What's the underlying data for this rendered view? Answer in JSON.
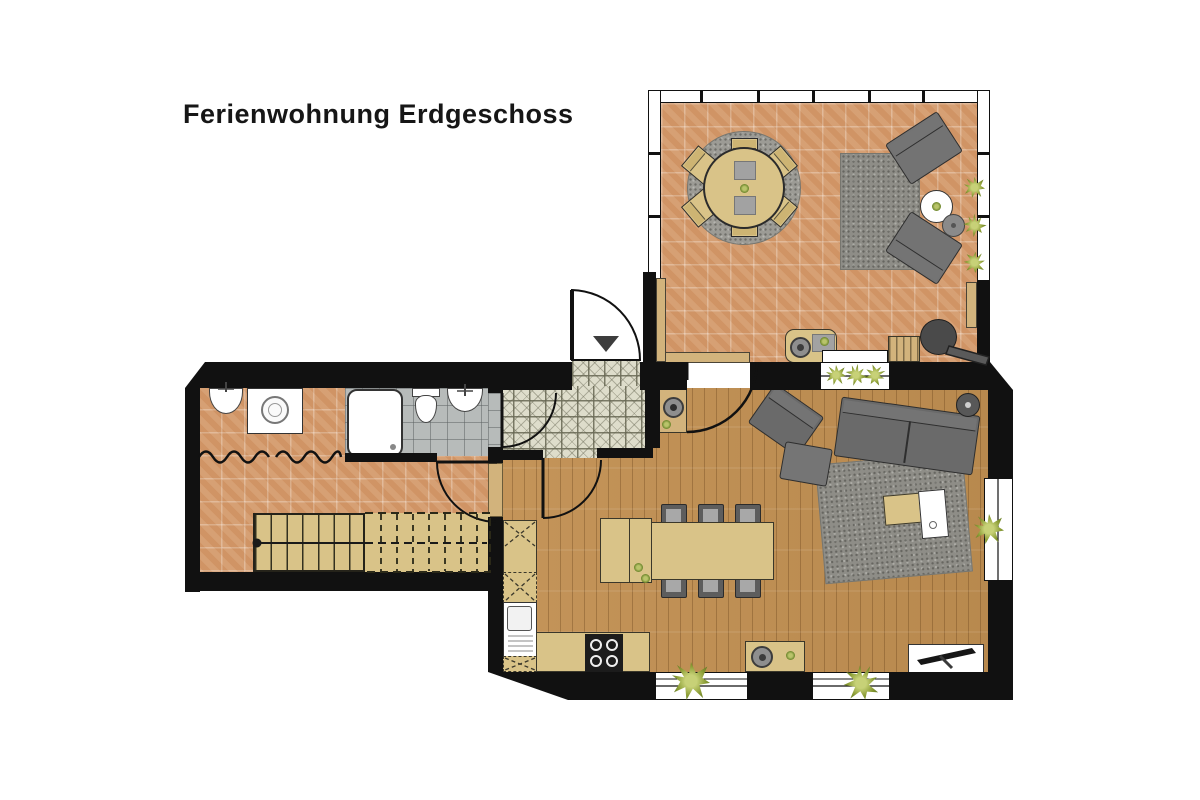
{
  "title": "Ferienwohnung Erdgeschoss",
  "palette": {
    "wall": "#111111",
    "wood_floor": "#c19158",
    "terracotta_tile": "#d49a6b",
    "bath_tile": "#b7bbba",
    "hall_tile": "#deddcb",
    "furniture_tan": "#d9c388",
    "furniture_gray": "#6a6a6a",
    "rug_gray": "#8e8d87",
    "plant_green": "#7c8f2e",
    "white": "#ffffff"
  },
  "rooms": {
    "terrace": {
      "furniture": [
        "round-dining-table",
        "dining-chair x6",
        "round-rug",
        "outdoor-rug",
        "lounge-chair x2",
        "white-side-table",
        "stool",
        "kettle-grill",
        "grill-station",
        "doormat",
        "plant x3"
      ]
    },
    "living_dining": {
      "furniture": [
        "sofa",
        "armchair",
        "ottoman",
        "rug",
        "coffee-table",
        "white-coffee-table",
        "round-stool",
        "tv-sideboard",
        "tv",
        "wood-stove",
        "dining-table",
        "dining-chair x6",
        "serving-trolley",
        "sideboard",
        "plant x4"
      ]
    },
    "kitchen": {
      "furniture": [
        "counter",
        "tall-cabinet",
        "kitchen-sink",
        "cooktop"
      ]
    },
    "bathroom": {
      "furniture": [
        "shower",
        "toilet",
        "washbasin"
      ]
    },
    "utility_room": {
      "furniture": [
        "washbasin",
        "washing-machine"
      ]
    },
    "hallway": {
      "features": [
        "front-door",
        "patterned-tile-floor",
        "entrance-marker"
      ]
    },
    "staircase": {
      "features": [
        "stairs-up",
        "walk-line"
      ]
    }
  }
}
